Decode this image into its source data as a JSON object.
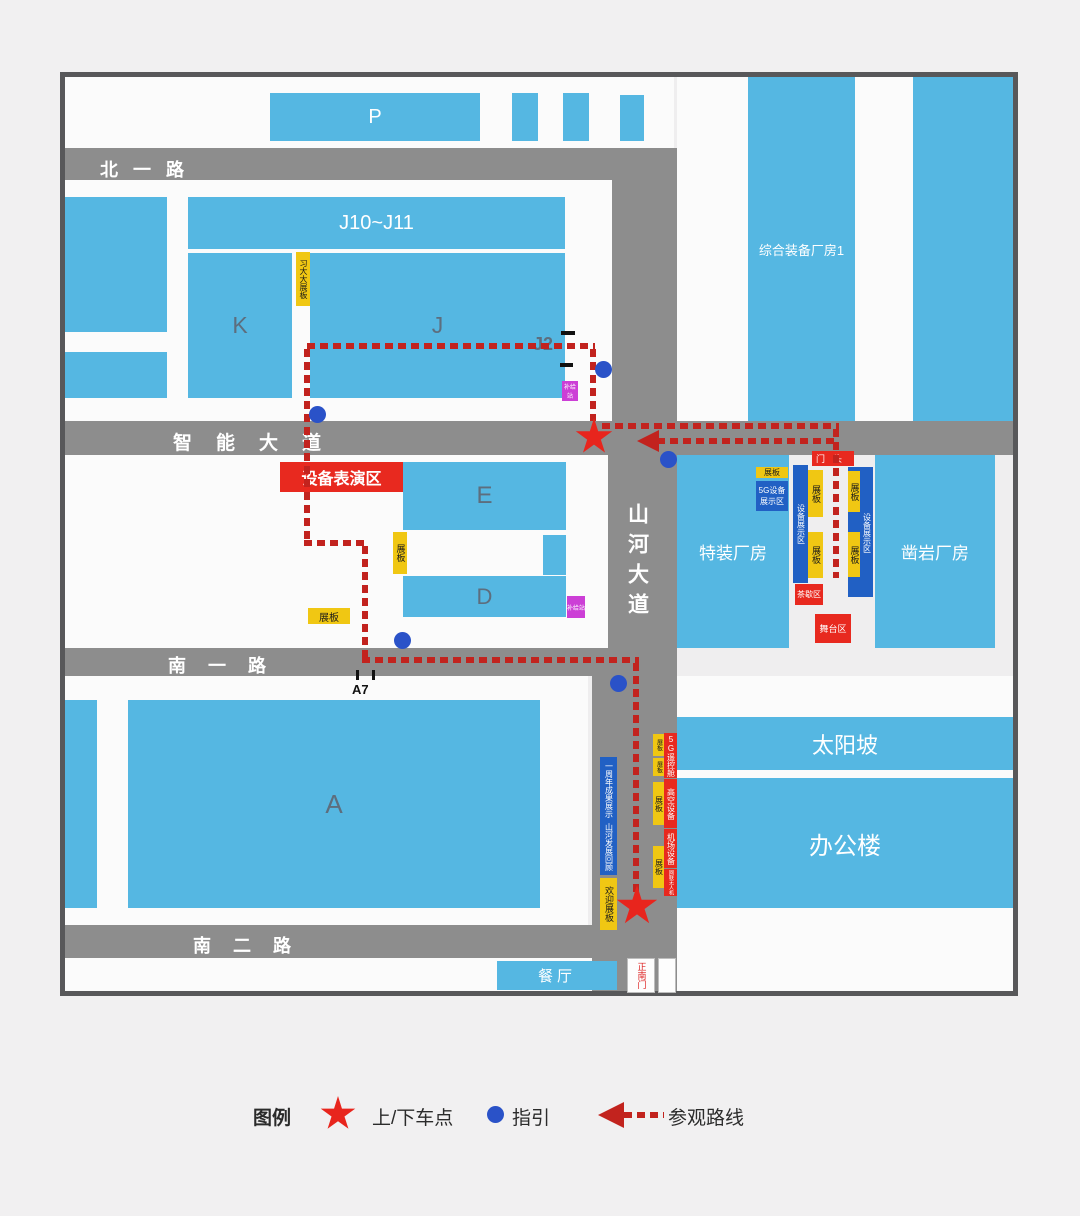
{
  "map": {
    "roads": {
      "north_road": "北一路",
      "smart_avenue": "智能大道",
      "shanhe_avenue": "山河大道",
      "south_road_1": "南一路",
      "south_road_2": "南二路"
    },
    "buildings": {
      "p": "P",
      "j10_j11": "J10~J11",
      "k": "K",
      "j": "J",
      "j2": "J2",
      "e": "E",
      "d": "D",
      "a": "A",
      "a7": "A7",
      "integrated_plant": "综合装备厂房1",
      "special_plant": "特装厂房",
      "rock_drill_plant": "凿岩厂房",
      "sun_slope": "太阳坡",
      "office_building": "办公楼",
      "restaurant": "餐厅"
    },
    "areas": {
      "equipment_show": "设备表演区",
      "gate_head": "门头",
      "sg_display": "5G设备展示区",
      "equipment_display": "设备展示区",
      "tea_break": "茶歇区",
      "stage": "舞台区",
      "supply_station": "补给站",
      "display_board": "展板",
      "xidada_board": "习大大展板",
      "welcome_board": "欢迎展板",
      "anniversary": "一周年成果展示",
      "shanhe_review": "山河发展回顾",
      "sg_remote": "5G遥控舱",
      "aerial_equipment": "高空设备",
      "airport_equipment": "机场设备",
      "networked_drone": "网联无人机",
      "south_gate": "正南门"
    }
  },
  "legend": {
    "title": "图例",
    "pickup": "上/下车点",
    "guide": "指引",
    "route": "参观路线"
  },
  "colors": {
    "building_blue": "#55b7e2",
    "road_gray": "#8d8d8d",
    "accent_red": "#e8291f",
    "route_red": "#c2231e",
    "board_yellow": "#f0c713",
    "deep_blue": "#2160c4",
    "magenta": "#cc3fd6",
    "dot_blue": "#2a52c8"
  }
}
